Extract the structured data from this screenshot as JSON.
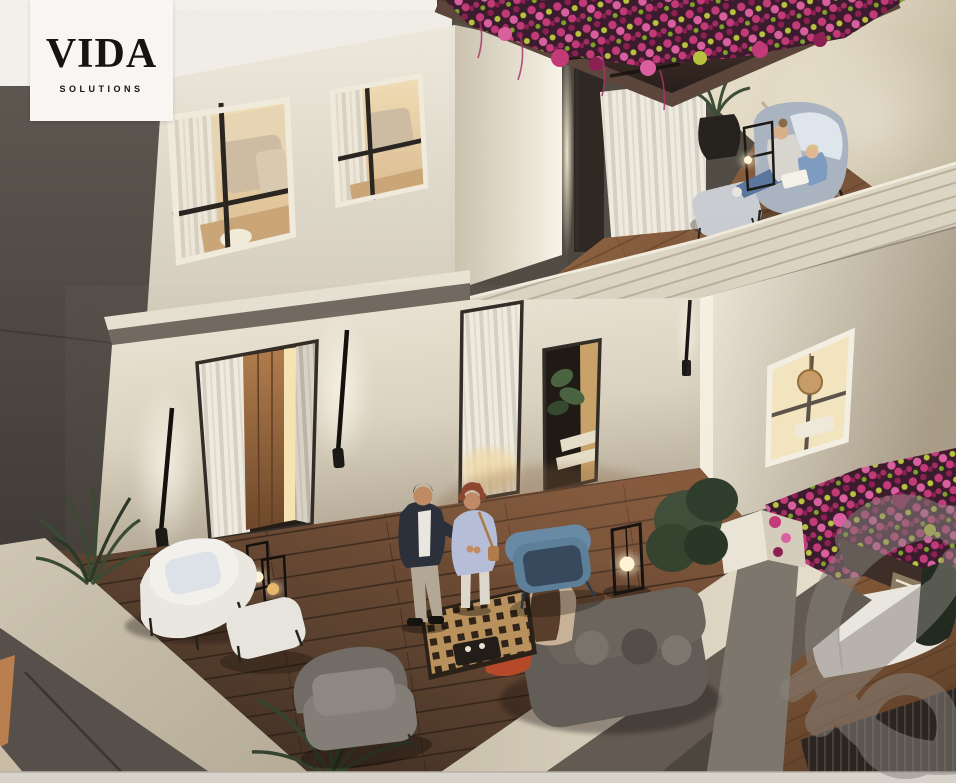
{
  "logo": {
    "title": "VIDA",
    "subtitle": "SOLUTIONS"
  },
  "watermark": {
    "shape": "circular-monogram-emblem",
    "opacity": 0.5
  },
  "palette": {
    "card_bg": "#f8f6f2",
    "logo_ink": "#17130e",
    "wall_cream": "#e9e3d3",
    "wall_dark": "#56504a",
    "deck_wood": "#6b4b36",
    "upper_deck_wood": "#9c6b44",
    "lower_deck_wood": "#8a5f3e",
    "pergola_brown": "#3c2e29",
    "flower_magenta": "#c23a78",
    "flower_pink": "#d95f9f",
    "flower_deep": "#8d2053",
    "flower_chartreuse": "#b9c23f",
    "parapet_light": "#d3cab8",
    "curtain_white": "#eeeae0",
    "window_warm": "#f0ddb6",
    "lantern_glow": "#fff3d2",
    "watermark_grey": "#8a857f",
    "bottom_strip": "#d7d3cb"
  }
}
